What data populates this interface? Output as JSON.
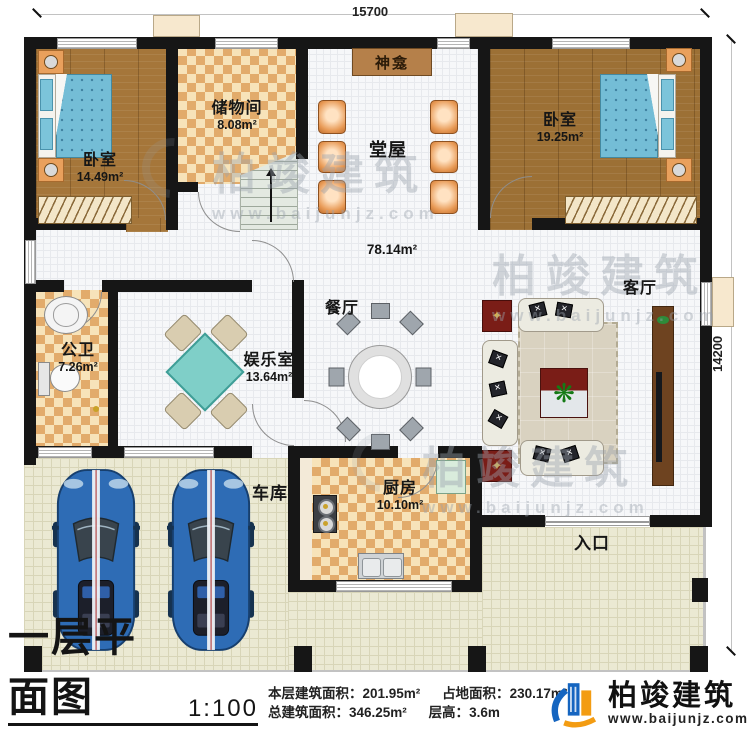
{
  "plan": {
    "dimensions": {
      "top": "15700",
      "right": "14200"
    },
    "rooms": {
      "bedroom_left": {
        "label": "卧室",
        "area": "14.49m²"
      },
      "storage": {
        "label": "储物间",
        "area": "8.08m²"
      },
      "shrine": {
        "label": "神龛"
      },
      "hall": {
        "label": "堂屋",
        "area": "78.14m²"
      },
      "bedroom_right": {
        "label": "卧室",
        "area": "19.25m²"
      },
      "bathroom": {
        "label": "公卫",
        "area": "7.26m²"
      },
      "game_room": {
        "label": "娱乐室",
        "area": "13.64m²"
      },
      "dining": {
        "label": "餐厅"
      },
      "living": {
        "label": "客厅"
      },
      "kitchen": {
        "label": "厨房",
        "area": "10.10m²"
      },
      "garage": {
        "label": "车库"
      },
      "entrance": {
        "label": "入口"
      }
    }
  },
  "watermark": {
    "text": "柏竣建筑",
    "url": "www.baijunjz.com"
  },
  "title_block": {
    "title": "一层平面图",
    "scale": "1:100",
    "stats": [
      {
        "label": "本层建筑面积：",
        "value": "201.95m²"
      },
      {
        "label": "占地面积：",
        "value": "230.17m²"
      },
      {
        "label": "总建筑面积：",
        "value": "346.25m²"
      },
      {
        "label": "层高：",
        "value": "3.6m"
      }
    ],
    "logo_name": "柏竣建筑",
    "logo_url": "www.baijunjz.com"
  },
  "colors": {
    "wall": "#161616",
    "wood_floor": "#a5763a",
    "checker_floor": "#e2ab6b",
    "tile_floor": "#f6f7f9",
    "outdoor_floor": "#ebe9d3",
    "car_blue": "#2e6cb5",
    "mattress_blue": "#74bdd6",
    "mahjong_teal": "#7fcfc8",
    "accent_red": "#7a1d17",
    "logo_blue": "#1565c0",
    "logo_orange": "#f39c12"
  }
}
